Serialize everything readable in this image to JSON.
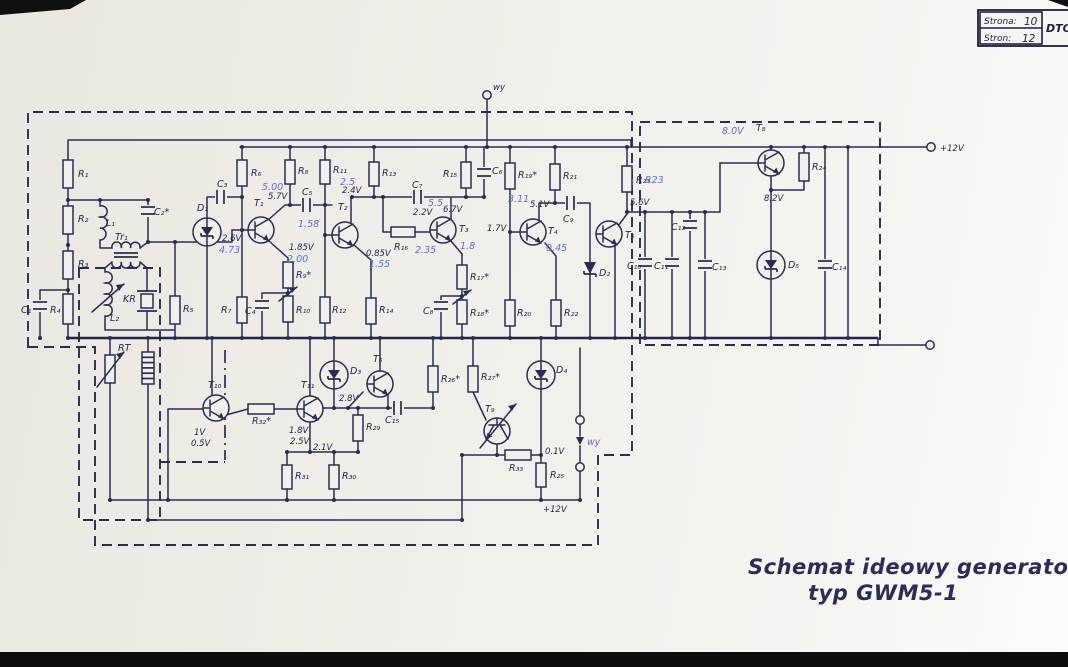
{
  "doc": {
    "title_line1": "Schemat ideowy generatora 5MHz",
    "title_line2": "typ GWM5-1"
  },
  "header_box": {
    "row1_label": "Strona:",
    "row1_num": "10",
    "row2_label": "Stron:",
    "row2_num": "12",
    "code": "DTO-"
  },
  "t": {
    "R1": "R₁",
    "R2": "R₂",
    "R3": "R₃",
    "R4": "R₄",
    "R5": "R₅",
    "R6": "R₆",
    "R7": "R₇",
    "R8": "R₈",
    "R9": "R₉*",
    "R10": "R₁₀",
    "R11": "R₁₁",
    "R12": "R₁₂",
    "R13": "R₁₃",
    "R14": "R₁₄",
    "R15": "R₁₅",
    "R16": "R₁₆",
    "R17": "R₁₇*",
    "R18": "R₁₈*",
    "R19": "R₁₉*",
    "R20": "R₂₀",
    "R21": "R₂₁",
    "R22": "R₂₂",
    "R23": "R₂₃",
    "R24": "R₂₄",
    "R25": "R₂₅",
    "R26": "R₂₆*",
    "R27": "R₂₇*",
    "R29": "R₂₉",
    "R30": "R₃₀",
    "R31": "R₃₁",
    "R32": "R₃₂*",
    "R33": "R₃₃",
    "C1": "C₁",
    "C2": "C₂*",
    "C3": "C₃",
    "C4": "C₄",
    "C5": "C₅",
    "C6": "C₆",
    "C7": "C₇",
    "C8": "C₈",
    "C9": "C₉",
    "C10": "C₁₀",
    "C11": "C₁₁",
    "C12": "C₁₂",
    "C13": "C₁₃",
    "C14": "C₁₄",
    "C15": "C₁₅",
    "L1": "L₁",
    "L2": "L₂",
    "Tr1": "Tr₁",
    "KR": "KR",
    "RT": "RT",
    "D1": "D₁",
    "D2": "D₂",
    "D3": "D₃",
    "D4": "D₄",
    "D5": "D₅",
    "T1": "T₁",
    "T2": "T₂",
    "T3": "T₃",
    "T4": "T₄",
    "T5": "T₅",
    "T6": "T₆",
    "T8": "T₈",
    "T9": "T₉",
    "T10": "T₁₀",
    "T11": "T₁₁"
  },
  "v": {
    "v57": "5.7V",
    "v26": "2.6V",
    "v185": "1.85V",
    "v24": "2.4V",
    "v085": "0.85V",
    "v22": "2.2V",
    "v67": "6.7V",
    "v17": "1.7V",
    "v51": "5.1V",
    "v56": "5.6V",
    "v82": "8.2V",
    "v1": "1V",
    "v05": "0.5V",
    "v18": "1.8V",
    "v25": "2.5V",
    "v28": "2.8V",
    "v21": "2.1V",
    "v01": "0.1V",
    "p12b": "+12V",
    "p12t": "+12V",
    "wy": "wy"
  },
  "hw": {
    "n500": "5.00",
    "n473": "4.73",
    "n200": "2.00",
    "n25": "2.5",
    "n158": "1.58",
    "n155": "1.55",
    "n235": "2.35",
    "n55": "5.5",
    "n311": "3.11",
    "n18": "1.8",
    "n045": "0.45",
    "nR23": "R23",
    "n80": "8.0V",
    "nwy": "wy"
  },
  "colors": {
    "ink": "#2b2b58",
    "handwriting_blue": "#5b6fd6",
    "paper": "#f1efe9"
  }
}
